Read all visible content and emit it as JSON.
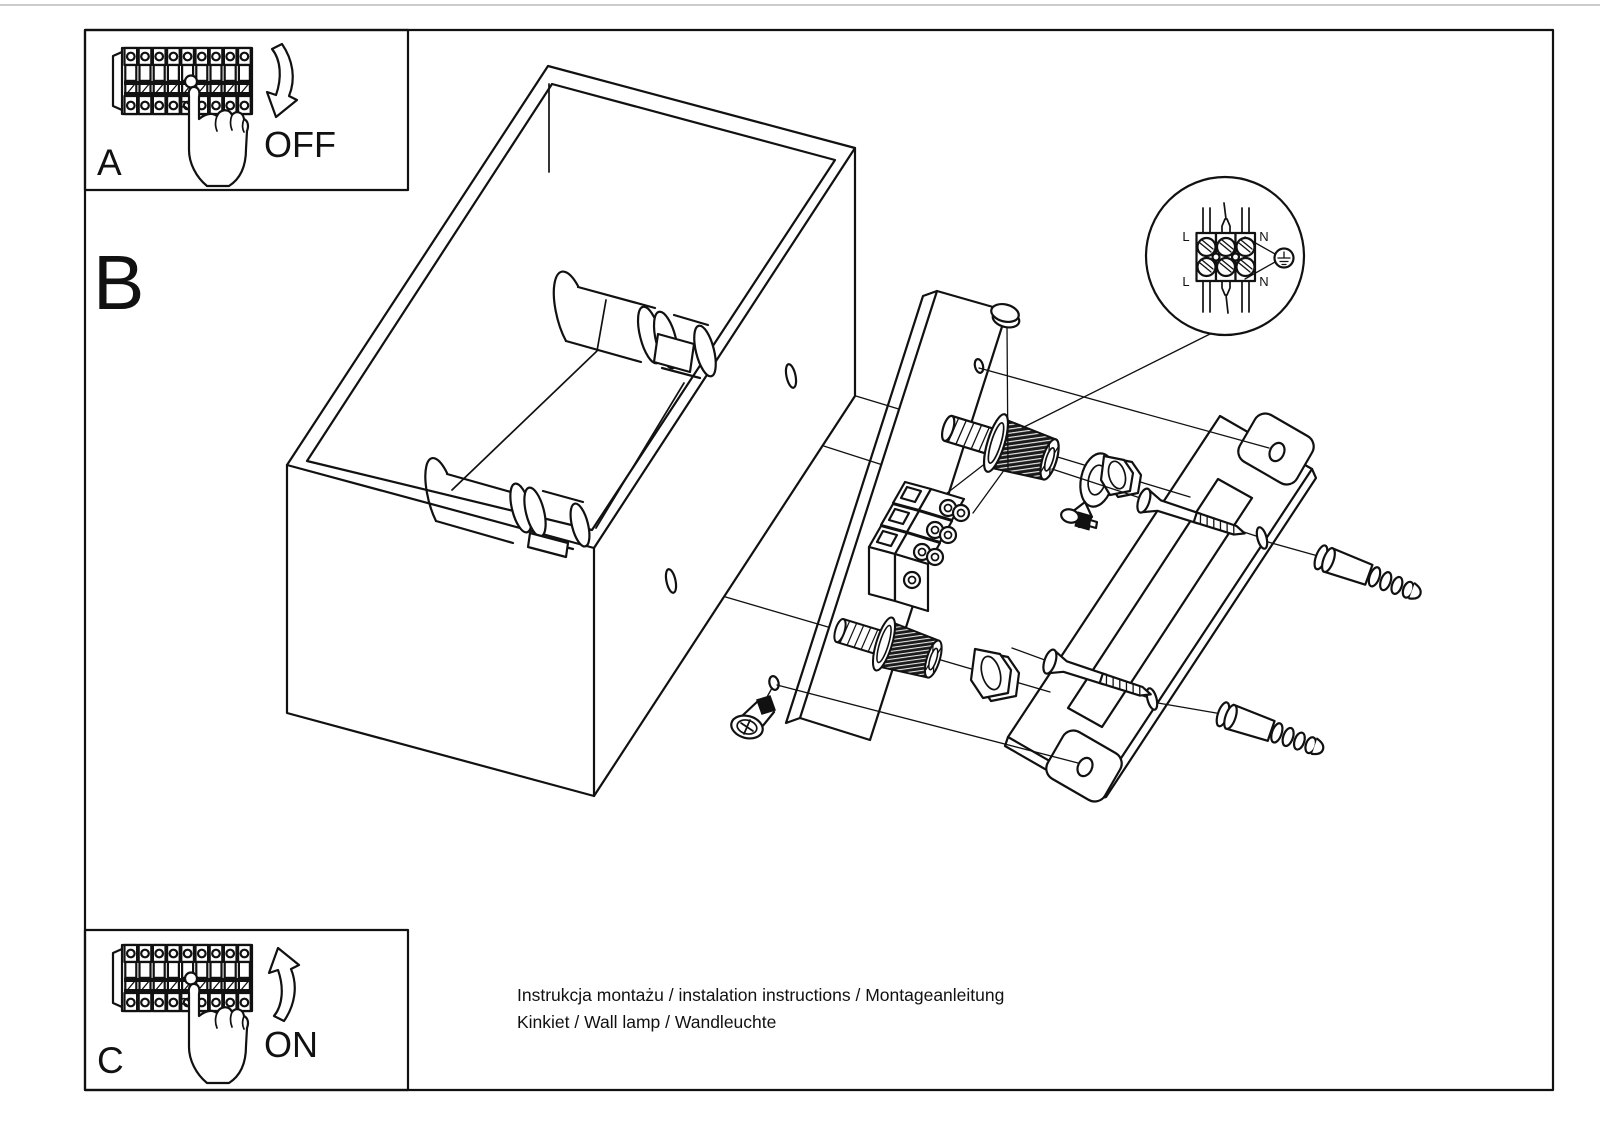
{
  "page": {
    "background": "#ffffff",
    "ink": "#111111",
    "type_label": "wall lamp installation instruction sheet"
  },
  "panels": {
    "a": {
      "label": "A",
      "state_label": "OFF",
      "icons": [
        "circuit-breaker-strip",
        "pressing-hand",
        "curved-arrow-down"
      ]
    },
    "b": {
      "label": "B",
      "icons": [
        "exploded-wall-lamp-drawing"
      ]
    },
    "c": {
      "label": "C",
      "state_label": "ON",
      "icons": [
        "circuit-breaker-strip",
        "pressing-hand",
        "curved-arrow-up"
      ]
    }
  },
  "wiring_inset": {
    "terminal_labels": {
      "l_top": "L",
      "l_bottom": "L",
      "n_top": "N",
      "n_bottom": "N"
    },
    "ground_icon": "earth-ground-symbol"
  },
  "captions": {
    "line1": "Instrukcja montażu / instalation instructions / Montageanleitung",
    "line2": "Kinkiet / Wall lamp / Wandleuchte"
  }
}
